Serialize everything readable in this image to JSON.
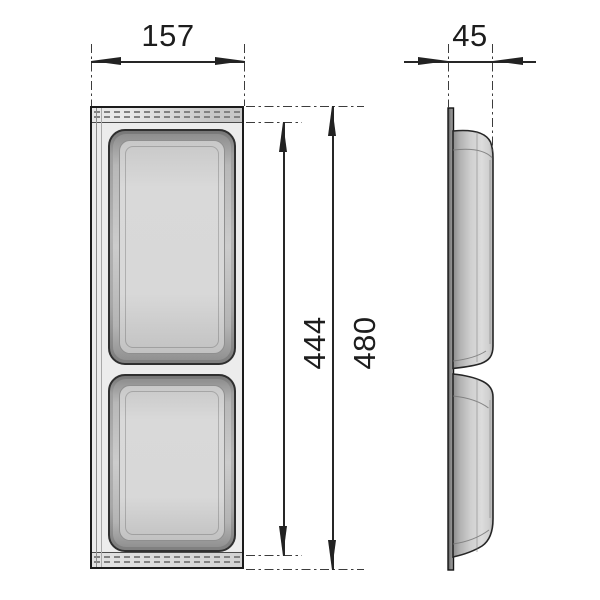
{
  "drawing": {
    "dimensions": {
      "width": "157",
      "depth": "45",
      "inner_height": "444",
      "overall_height": "480"
    },
    "colors": {
      "line": "#262626",
      "panel_fill": "#ececec",
      "tray_rim": "#8a8a8a",
      "tray_floor": "#d8d8d8",
      "side_plate": "#6f6f6f",
      "background": "#ffffff"
    }
  }
}
